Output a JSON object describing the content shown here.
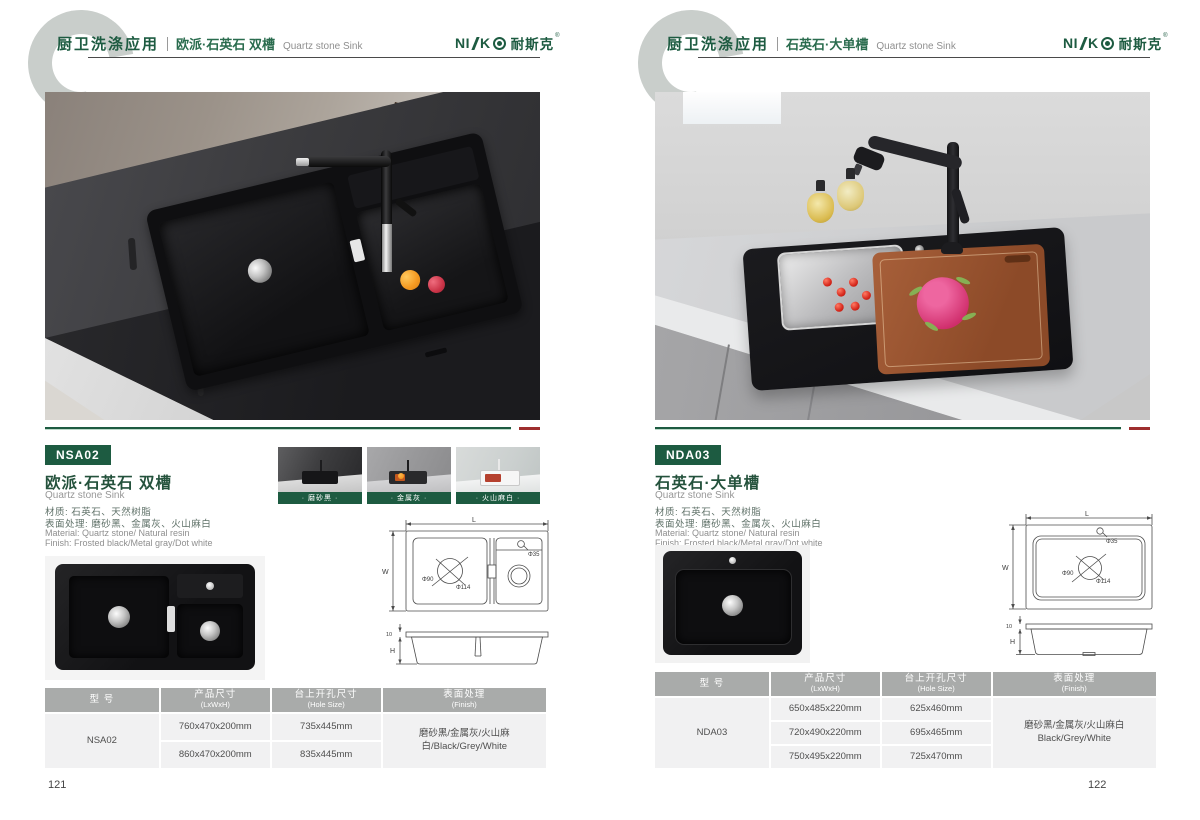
{
  "logo": {
    "ni": "NI",
    "k": "K",
    "cn": "耐斯克",
    "reg": "®"
  },
  "left": {
    "page_no": "121",
    "header": {
      "app": "厨卫洗涤应用",
      "title": "欧派·石英石 双槽",
      "subtitle": "Quartz stone Sink"
    },
    "product": {
      "model": "NSA02",
      "title": "欧派·石英石 双槽",
      "subtitle": "Quartz stone Sink",
      "mat_cn": "材质: 石英石、天然树脂",
      "fin_cn": "表面处理: 磨砂黑、金属灰、火山麻白",
      "mat_en": "Material: Quartz stone/ Natural resin",
      "fin_en": "Finish: Frosted black/Metal gray/Dot white"
    },
    "swatches": [
      {
        "label": "· 磨砂黑 ·"
      },
      {
        "label": "· 金属灰 ·"
      },
      {
        "label": "· 火山麻白 ·"
      }
    ],
    "drawing": {
      "l": "L",
      "w": "W",
      "h": "H",
      "flange": "10",
      "d35": "Φ35",
      "d90": "Φ90",
      "d114": "Φ114"
    },
    "table": {
      "h_model_cn": "型 号",
      "h_model_en": "",
      "h_size_cn": "产品尺寸",
      "h_size_en": "(LxWxH)",
      "h_hole_cn": "台上开孔尺寸",
      "h_hole_en": "(Hole Size)",
      "h_finish_cn": "表面处理",
      "h_finish_en": "(Finish)",
      "model": "NSA02",
      "rows": [
        {
          "size": "760x470x200mm",
          "hole": "735x445mm"
        },
        {
          "size": "860x470x200mm",
          "hole": "835x445mm"
        }
      ],
      "finish": "磨砂黑/金属灰/火山麻白/Black/Grey/White"
    }
  },
  "right": {
    "page_no": "122",
    "header": {
      "app": "厨卫洗涤应用",
      "title": "石英石·大单槽",
      "subtitle": "Quartz stone Sink"
    },
    "product": {
      "model": "NDA03",
      "title": "石英石·大单槽",
      "subtitle": "Quartz stone Sink",
      "mat_cn": "材质: 石英石、天然树脂",
      "fin_cn": "表面处理: 磨砂黑、金属灰、火山麻白",
      "mat_en": "Material: Quartz stone/ Natural resin",
      "fin_en": "Finish: Frosted black/Metal gray/Dot white"
    },
    "drawing": {
      "l": "L",
      "w": "W",
      "h": "H",
      "flange": "10",
      "d35": "Φ35",
      "d90": "Φ90",
      "d114": "Φ114"
    },
    "table": {
      "h_model_cn": "型 号",
      "h_model_en": "",
      "h_size_cn": "产品尺寸",
      "h_size_en": "(LxWxH)",
      "h_hole_cn": "台上开孔尺寸",
      "h_hole_en": "(Hole Size)",
      "h_finish_cn": "表面处理",
      "h_finish_en": "(Finish)",
      "model": "NDA03",
      "rows": [
        {
          "size": "650x485x220mm",
          "hole": "625x460mm"
        },
        {
          "size": "720x490x220mm",
          "hole": "695x465mm"
        },
        {
          "size": "750x495x220mm",
          "hole": "725x470mm"
        }
      ],
      "finish_cn": "磨砂黑/金属灰/火山麻白",
      "finish_en": "Black/Grey/White"
    }
  }
}
